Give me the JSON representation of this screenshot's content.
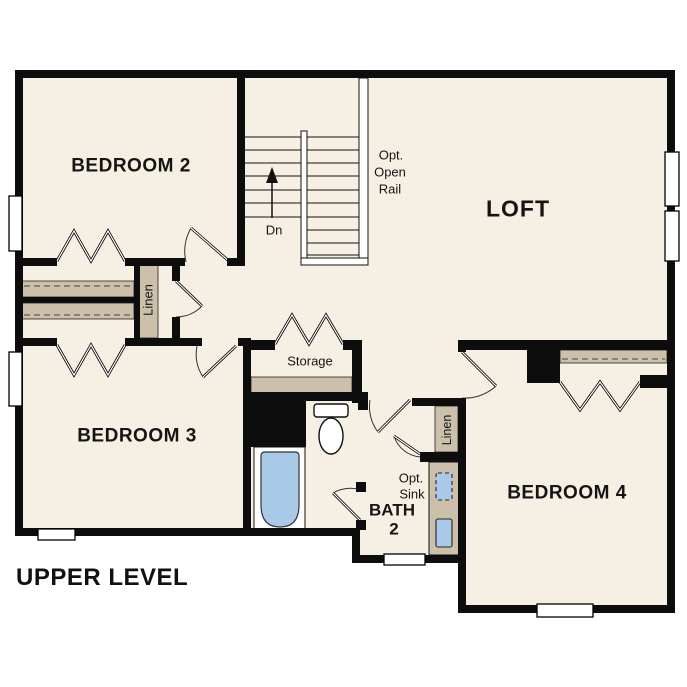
{
  "title": "UPPER LEVEL",
  "rooms": {
    "bedroom2": {
      "label": "BEDROOM 2"
    },
    "bedroom3": {
      "label": "BEDROOM 3"
    },
    "bedroom4": {
      "label": "BEDROOM 4"
    },
    "loft": {
      "label": "LOFT"
    },
    "bath2": {
      "line1": "BATH",
      "line2": "2"
    },
    "storage": {
      "label": "Storage"
    },
    "linen_hall": {
      "label": "Linen"
    },
    "linen_bath": {
      "label": "Linen"
    }
  },
  "annotations": {
    "stairs_direction": "Dn",
    "opt_open_rail": [
      "Opt.",
      "Open",
      "Rail"
    ],
    "opt_sink": [
      "Opt.",
      "Sink"
    ]
  },
  "colors": {
    "wall": "#0d0d0d",
    "floor": "#f6efe3",
    "casework": "#cdc0aa",
    "fixture_blue": "#a9c9e8",
    "line": "#1a1a1a",
    "background": "#ffffff"
  }
}
